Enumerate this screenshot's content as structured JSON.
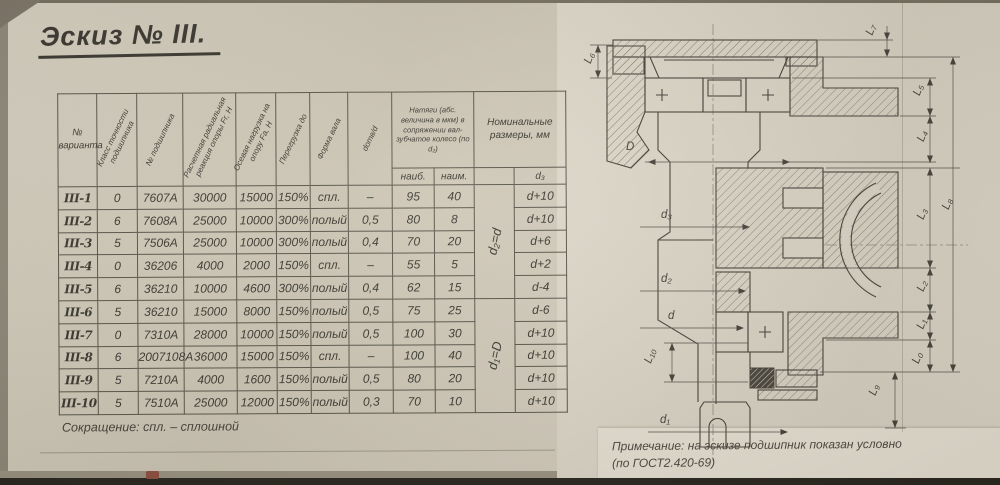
{
  "title": "Эскиз № III.",
  "table": {
    "headers": {
      "variant": "№ варианта",
      "accuracy_class": "Класс точности подшипника",
      "bearing_no": "№ подшипника",
      "radial_reaction": "Расчетная радиальная реакция опоры Fr, Н",
      "axial_load": "Осевая нагрузка на опору Fа, Н",
      "overload": "Перегрузка до",
      "shaft_form": "Форма вала",
      "hole_ratio": "dотв/d",
      "interference": "Натяги (абс. величина в мкм) в сопряжении вал-зубчатое колесо (по d₂)",
      "max": "наиб.",
      "min": "наим.",
      "nominal": "Номинальные размеры, мм",
      "d3": "d₃",
      "group1": "d₂=d",
      "group2": "d₁=D"
    },
    "col_keys": [
      "variant",
      "accuracy-class",
      "bearing-no",
      "radial-reaction",
      "axial-load",
      "overload",
      "shaft-form",
      "hole-ratio",
      "interference-max",
      "interference-min",
      "d3"
    ],
    "rows": [
      [
        "III-1",
        "0",
        "7607А",
        "30000",
        "15000",
        "150%",
        "спл.",
        "–",
        "95",
        "40",
        "d+10"
      ],
      [
        "III-2",
        "6",
        "7608А",
        "25000",
        "10000",
        "300%",
        "полый",
        "0,5",
        "80",
        "8",
        "d+10"
      ],
      [
        "III-3",
        "5",
        "7506А",
        "25000",
        "10000",
        "300%",
        "полый",
        "0,4",
        "70",
        "20",
        "d+6"
      ],
      [
        "III-4",
        "0",
        "36206",
        "4000",
        "2000",
        "150%",
        "спл.",
        "–",
        "55",
        "5",
        "d+2"
      ],
      [
        "III-5",
        "6",
        "36210",
        "10000",
        "4600",
        "300%",
        "полый",
        "0,4",
        "62",
        "15",
        "d-4"
      ],
      [
        "III-6",
        "5",
        "36210",
        "15000",
        "8000",
        "150%",
        "полый",
        "0,5",
        "75",
        "25",
        "d-6"
      ],
      [
        "III-7",
        "0",
        "7310А",
        "28000",
        "10000",
        "150%",
        "полый",
        "0,5",
        "100",
        "30",
        "d+10"
      ],
      [
        "III-8",
        "6",
        "2007108А",
        "36000",
        "15000",
        "150%",
        "спл.",
        "–",
        "100",
        "40",
        "d+10"
      ],
      [
        "III-9",
        "5",
        "7210А",
        "4000",
        "1600",
        "150%",
        "полый",
        "0,5",
        "80",
        "20",
        "d+10"
      ],
      [
        "III-10",
        "5",
        "7510А",
        "25000",
        "12000",
        "150%",
        "полый",
        "0,3",
        "70",
        "10",
        "d+10"
      ]
    ],
    "footnote": "Сокращение: спл. – сплошной"
  },
  "drawing": {
    "labels": {
      "L6": "L₆",
      "L7": "L₇",
      "L5": "L₅",
      "L4": "L₄",
      "L8": "L₈",
      "L3": "L₃",
      "L2": "L₂",
      "L1": "L₁",
      "L0": "L₀",
      "L9": "L₉",
      "L10": "L₁₀",
      "D": "D",
      "d3": "d₃",
      "d2": "d₂",
      "d": "d",
      "d1": "d₁"
    },
    "note_line1": "Примечание: на эскизе подшипник показан условно",
    "note_line2": "(по ГОСТ2.420-69)"
  }
}
